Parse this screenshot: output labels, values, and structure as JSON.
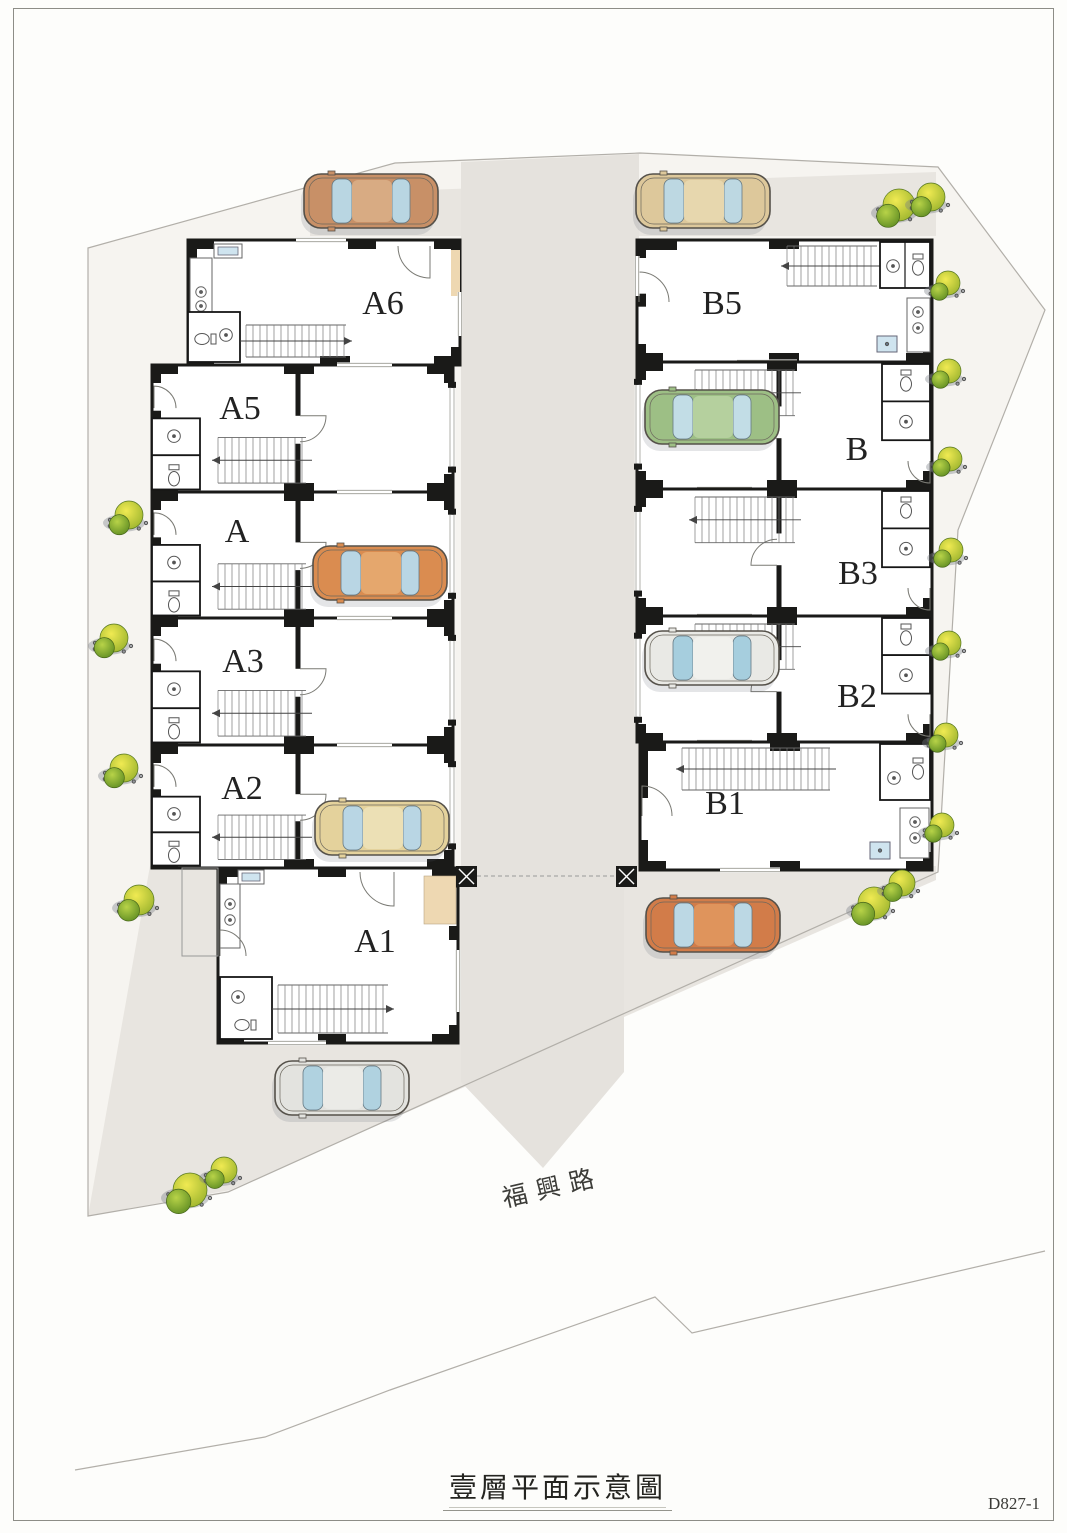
{
  "page": {
    "title": "壹層平面示意圖",
    "doc_no": "D827-1"
  },
  "road": {
    "name": "福興路"
  },
  "colors": {
    "wall": "#1a1a18",
    "paving": "#e8e5e0",
    "site": "#f6f4f0",
    "boundary": "#b2afa9",
    "glass": "#bcd8e4",
    "tan_patch": "#eed8b2",
    "sink_blue": "#cfe4ef"
  },
  "site": {
    "outline": [
      [
        88,
        248
      ],
      [
        395,
        163
      ],
      [
        640,
        153
      ],
      [
        938,
        167
      ],
      [
        1045,
        310
      ],
      [
        958,
        530
      ],
      [
        938,
        872
      ],
      [
        228,
        1192
      ],
      [
        88,
        1216
      ]
    ],
    "contour": [
      [
        75,
        1470
      ],
      [
        265,
        1437
      ],
      [
        390,
        1390
      ],
      [
        655,
        1297
      ],
      [
        692,
        1333
      ],
      [
        1045,
        1251
      ]
    ],
    "top_strip": [
      [
        310,
        194
      ],
      [
        936,
        172
      ],
      [
        936,
        236
      ],
      [
        310,
        236
      ]
    ],
    "driveway": [
      [
        461,
        162
      ],
      [
        639,
        154
      ],
      [
        639,
        874
      ],
      [
        624,
        890
      ],
      [
        624,
        1072
      ],
      [
        543,
        1168
      ],
      [
        461,
        1082
      ]
    ],
    "apron": [
      [
        150,
        866
      ],
      [
        936,
        866
      ],
      [
        936,
        880
      ],
      [
        230,
        1190
      ],
      [
        88,
        1216
      ]
    ]
  },
  "buildings": {
    "units": [
      {
        "id": "A6",
        "label": "A6",
        "x": 188,
        "y": 240,
        "w": 272,
        "h": 125,
        "lx": 383,
        "ly": 302,
        "variant": "a-top"
      },
      {
        "id": "A5",
        "label": "A5",
        "x": 152,
        "y": 365,
        "w": 301,
        "h": 127,
        "lx": 240,
        "ly": 407,
        "variant": "a-mid"
      },
      {
        "id": "A",
        "label": "A",
        "x": 152,
        "y": 492,
        "w": 301,
        "h": 126,
        "lx": 237,
        "ly": 530,
        "variant": "a-mid"
      },
      {
        "id": "A3",
        "label": "A3",
        "x": 152,
        "y": 618,
        "w": 301,
        "h": 127,
        "lx": 243,
        "ly": 660,
        "variant": "a-mid"
      },
      {
        "id": "A2",
        "label": "A2",
        "x": 152,
        "y": 745,
        "w": 301,
        "h": 123,
        "lx": 242,
        "ly": 787,
        "variant": "a-mid"
      },
      {
        "id": "A1",
        "label": "A1",
        "x": 218,
        "y": 868,
        "w": 240,
        "h": 175,
        "lx": 375,
        "ly": 940,
        "variant": "a-bottom"
      },
      {
        "id": "B5",
        "label": "B5",
        "x": 637,
        "y": 240,
        "w": 295,
        "h": 122,
        "lx": 722,
        "ly": 302,
        "variant": "b-top"
      },
      {
        "id": "B",
        "label": "B",
        "x": 637,
        "y": 362,
        "w": 295,
        "h": 127,
        "lx": 857,
        "ly": 448,
        "variant": "b-mid"
      },
      {
        "id": "B3",
        "label": "B3",
        "x": 637,
        "y": 489,
        "w": 295,
        "h": 127,
        "lx": 858,
        "ly": 572,
        "variant": "b-mid"
      },
      {
        "id": "B2",
        "label": "B2",
        "x": 637,
        "y": 616,
        "w": 295,
        "h": 126,
        "lx": 857,
        "ly": 695,
        "variant": "b-mid"
      },
      {
        "id": "B1",
        "label": "B1",
        "x": 640,
        "y": 742,
        "w": 292,
        "h": 128,
        "lx": 725,
        "ly": 802,
        "variant": "b-bottom"
      }
    ]
  },
  "gate": {
    "x1": 456,
    "x2": 616,
    "y": 866,
    "size": 21
  },
  "cars": [
    {
      "name": "tan-car-top-left",
      "x": 371,
      "y": 201,
      "body": "#c89067",
      "roof": "#d8ab83",
      "glass": "#b9d6e2"
    },
    {
      "name": "khaki-car-top-right",
      "x": 703,
      "y": 201,
      "body": "#ddc89b",
      "roof": "#e7d7ae",
      "glass": "#bdd8e2"
    },
    {
      "name": "green-car-unit-b",
      "x": 712,
      "y": 417,
      "body": "#9dbf85",
      "roof": "#b5d09e",
      "glass": "#c2dde6"
    },
    {
      "name": "orange-car-unit-a",
      "x": 380,
      "y": 573,
      "body": "#da8c50",
      "roof": "#e5a76d",
      "glass": "#b9d6e4"
    },
    {
      "name": "white-car-unit-b2",
      "x": 712,
      "y": 658,
      "body": "#e9e9e5",
      "roof": "#f1f1ed",
      "glass": "#a6cede"
    },
    {
      "name": "cream-car-unit-a2",
      "x": 382,
      "y": 828,
      "body": "#e4d29c",
      "roof": "#ece0b5",
      "glass": "#b9d6e4"
    },
    {
      "name": "orange-car-bottom-right",
      "x": 713,
      "y": 925,
      "body": "#d27c49",
      "roof": "#df945c",
      "glass": "#bcd8e4"
    },
    {
      "name": "silver-car-bottom-left",
      "x": 342,
      "y": 1088,
      "body": "#e3e3df",
      "roof": "#ebebe7",
      "glass": "#b0d2e0"
    }
  ],
  "plants": [
    {
      "x": 897,
      "y": 207,
      "r": 16
    },
    {
      "x": 929,
      "y": 199,
      "r": 14
    },
    {
      "x": 946,
      "y": 285,
      "r": 12
    },
    {
      "x": 947,
      "y": 373,
      "r": 12
    },
    {
      "x": 948,
      "y": 461,
      "r": 12
    },
    {
      "x": 949,
      "y": 552,
      "r": 12
    },
    {
      "x": 947,
      "y": 645,
      "r": 12
    },
    {
      "x": 944,
      "y": 737,
      "r": 12
    },
    {
      "x": 940,
      "y": 827,
      "r": 12
    },
    {
      "x": 872,
      "y": 905,
      "r": 16
    },
    {
      "x": 900,
      "y": 885,
      "r": 13
    },
    {
      "x": 127,
      "y": 517,
      "r": 14
    },
    {
      "x": 112,
      "y": 640,
      "r": 14
    },
    {
      "x": 122,
      "y": 770,
      "r": 14
    },
    {
      "x": 137,
      "y": 902,
      "r": 15
    },
    {
      "x": 188,
      "y": 1192,
      "r": 17
    },
    {
      "x": 222,
      "y": 1172,
      "r": 13
    }
  ]
}
